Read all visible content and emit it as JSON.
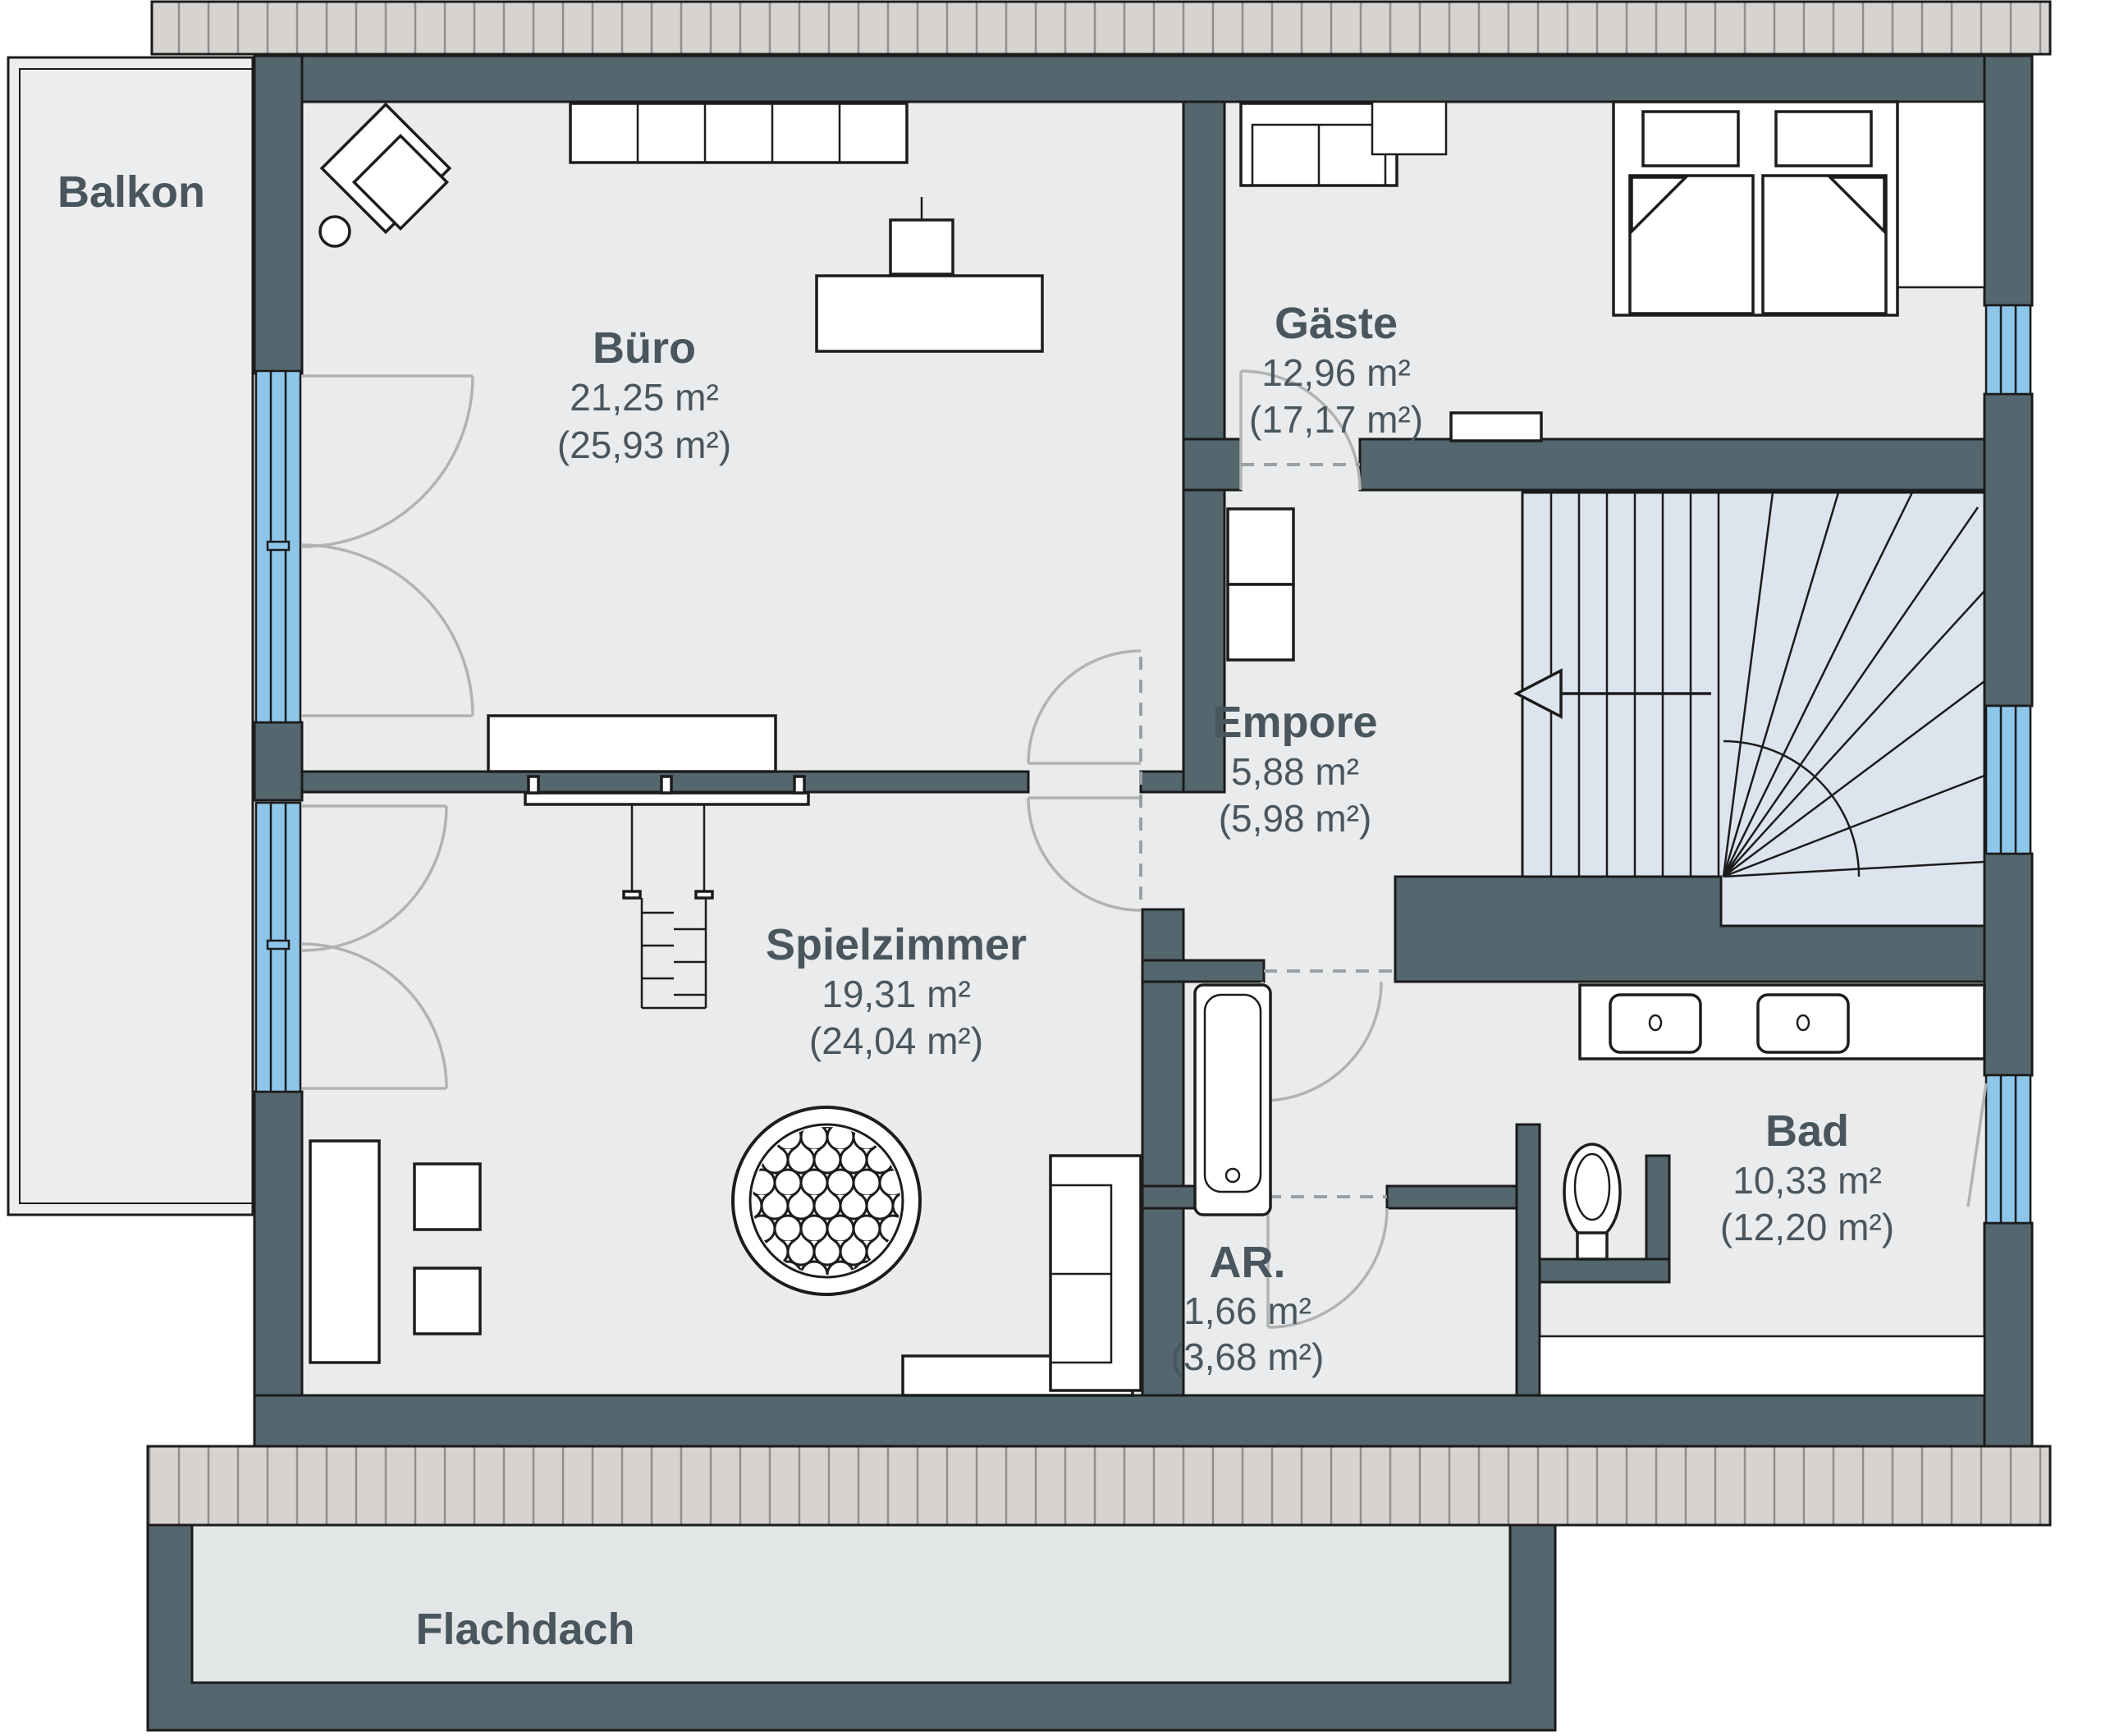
{
  "plan": {
    "balcony_label": "Balkon",
    "flat_roof_label": "Flachdach",
    "rooms": {
      "buero": {
        "name": "Büro",
        "area": "21,25 m²",
        "area_gross": "(25,93 m²)"
      },
      "gaeste": {
        "name": "Gäste",
        "area": "12,96 m²",
        "area_gross": "(17,17 m²)"
      },
      "empore": {
        "name": "Empore",
        "area": "5,88 m²",
        "area_gross": "(5,98 m²)"
      },
      "spielzimmer": {
        "name": "Spielzimmer",
        "area": "19,31 m²",
        "area_gross": "(24,04 m²)"
      },
      "ar": {
        "name": "AR.",
        "area": "1,66 m²",
        "area_gross": "(3,68 m²)"
      },
      "bad": {
        "name": "Bad",
        "area": "10,33 m²",
        "area_gross": "(12,20 m²)"
      }
    },
    "colors": {
      "wall": "#54666e",
      "floor": "#e9ebec",
      "window_glass": "#8ec6ea",
      "stair_fill": "#dce4ee",
      "label_text": "#4a565e",
      "eaves_fill": "#d7d3d1"
    }
  }
}
